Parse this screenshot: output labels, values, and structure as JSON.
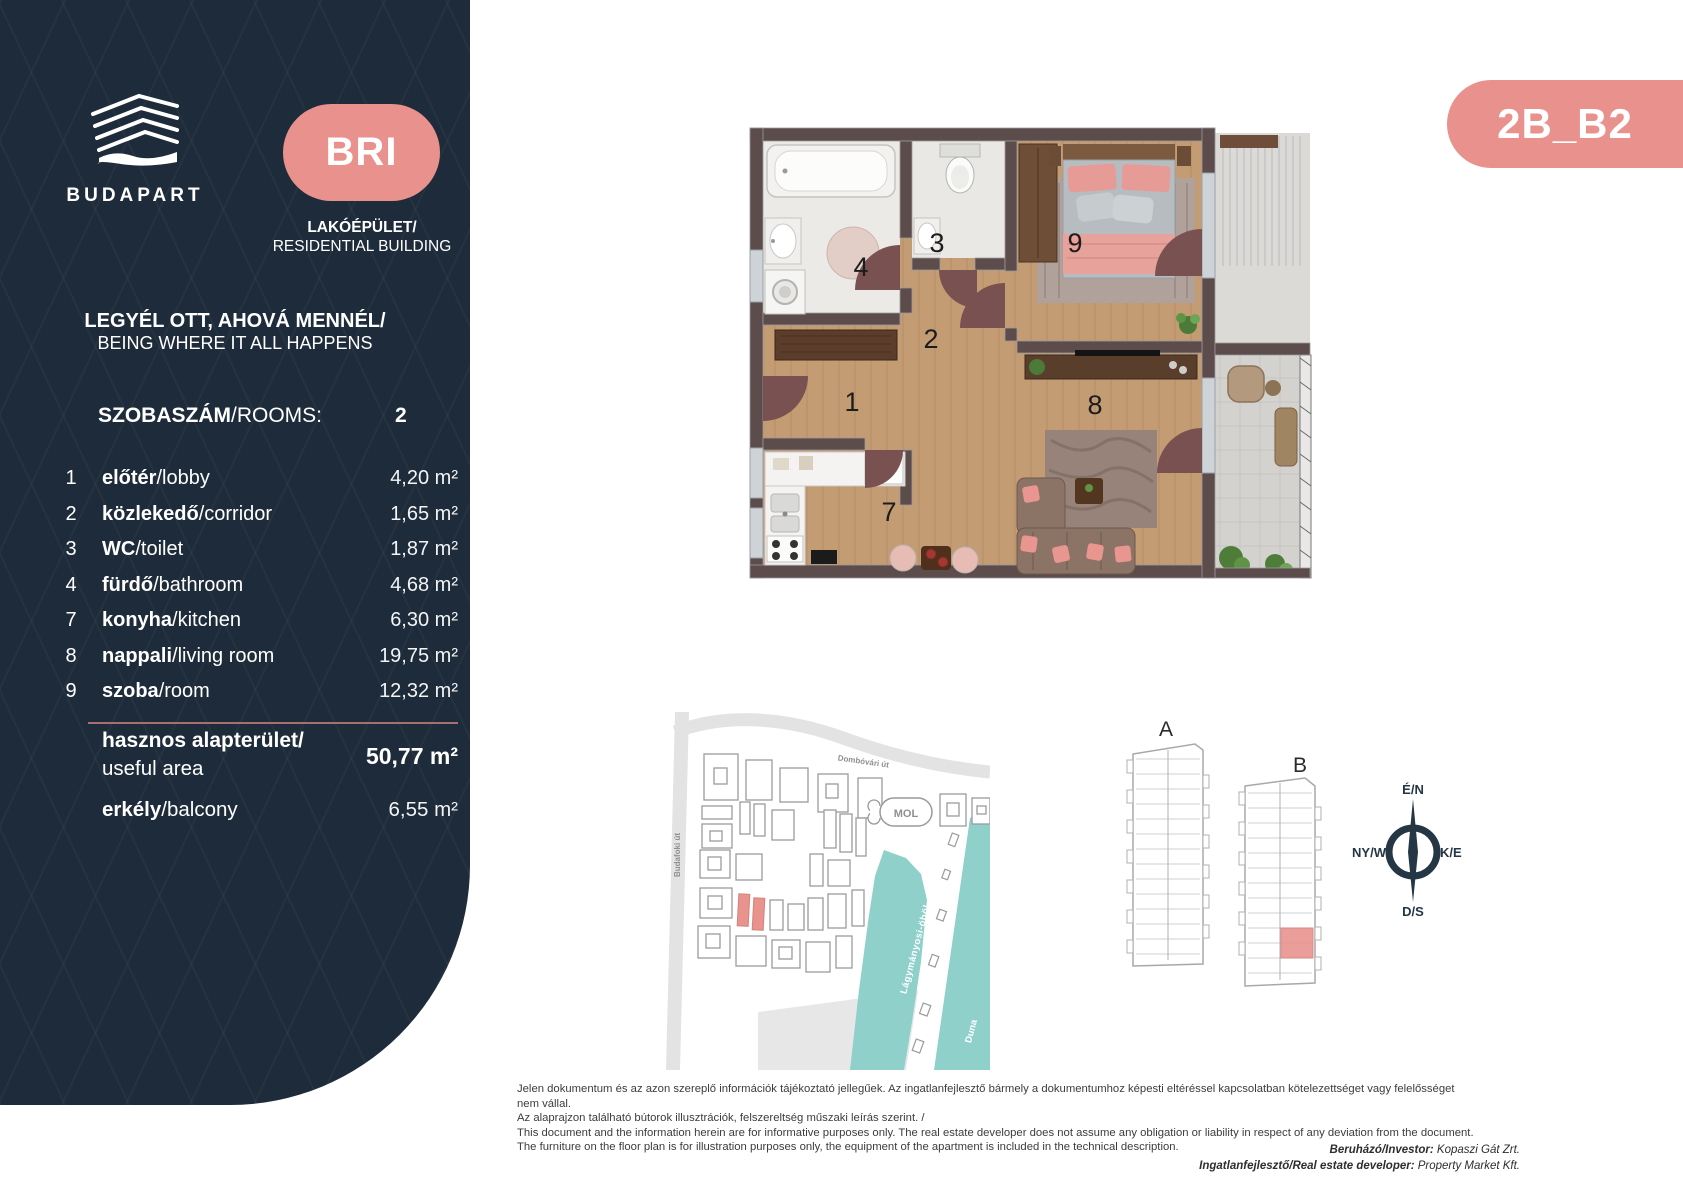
{
  "sidebar": {
    "brand": "BUDAPART",
    "badge_label": "BRI",
    "building_hu": "LAKÓÉPÜLET/",
    "building_en": "RESIDENTIAL BUILDING",
    "slogan_hu": "LEGYÉL OTT, AHOVÁ MENNÉL/",
    "slogan_en": "BEING WHERE IT ALL HAPPENS",
    "rooms_label_bold": "SZOBASZÁM",
    "rooms_label_rest": "/ROOMS:",
    "rooms_value": "2",
    "rows": [
      {
        "num": "1",
        "hu": "előtér",
        "en": "/lobby",
        "area": "4,20 m²"
      },
      {
        "num": "2",
        "hu": "közlekedő",
        "en": "/corridor",
        "area": "1,65 m²"
      },
      {
        "num": "3",
        "hu": "WC",
        "en": "/toilet",
        "area": "1,87 m²"
      },
      {
        "num": "4",
        "hu": "fürdő",
        "en": "/bathroom",
        "area": "4,68 m²"
      },
      {
        "num": "7",
        "hu": "konyha",
        "en": "/kitchen",
        "area": "6,30 m²"
      },
      {
        "num": "8",
        "hu": "nappali",
        "en": "/living room",
        "area": "19,75 m²"
      },
      {
        "num": "9",
        "hu": "szoba",
        "en": "/room",
        "area": "12,32 m²"
      }
    ],
    "total_hu": "hasznos alapterület/",
    "total_en": "useful area",
    "total_area": "50,77 m²",
    "balcony_hu": "erkély",
    "balcony_en": "/balcony",
    "balcony_area": "6,55 m²"
  },
  "unit_badge": "2B_B2",
  "floorplan": {
    "numbers": {
      "lobby": "1",
      "corridor": "2",
      "wc": "3",
      "bath": "4",
      "kitchen": "7",
      "living": "8",
      "room": "9"
    },
    "fridge_icon": "❄"
  },
  "sitemap": {
    "street_vertical": "Budafoki út",
    "street_top": "Dombóvári út",
    "station": "MOL",
    "bay": "Lágymányosi-öböl",
    "river": "Duna"
  },
  "buildings": {
    "a": "A",
    "b": "B"
  },
  "compass": {
    "north": "É/N",
    "west": "NY/W",
    "east": "K/E",
    "south": "D/S"
  },
  "disclaimer": {
    "l1": "Jelen dokumentum és az azon szereplő információk tájékoztató jellegűek. Az ingatlanfejlesztő bármely a dokumentumhoz képesti eltéréssel kapcsolatban kötelezettséget vagy felelősséget nem vállal.",
    "l2": "Az alaprajzon található bútorok illusztrációk, felszereltség műszaki leírás szerint. /",
    "l3": "This document and the information herein are for informative purposes only. The real estate developer does not assume any obligation or liability in respect of any deviation from the document.",
    "l4": "The furniture on the floor plan is for illustration purposes only, the equipment of the apartment is included in the technical description."
  },
  "credits": {
    "investor_label": "Beruházó/Investor:",
    "investor_value": " Kopaszi Gát Zrt.",
    "developer_label": "Ingatlanfejlesztő/Real estate developer:",
    "developer_value": " Property Market Kft."
  },
  "colors": {
    "navy": "#1e2b3a",
    "pink": "#e8918d",
    "teal": "#8fd0cb",
    "wall": "#5d4c4c",
    "wood": "#c49c74"
  }
}
